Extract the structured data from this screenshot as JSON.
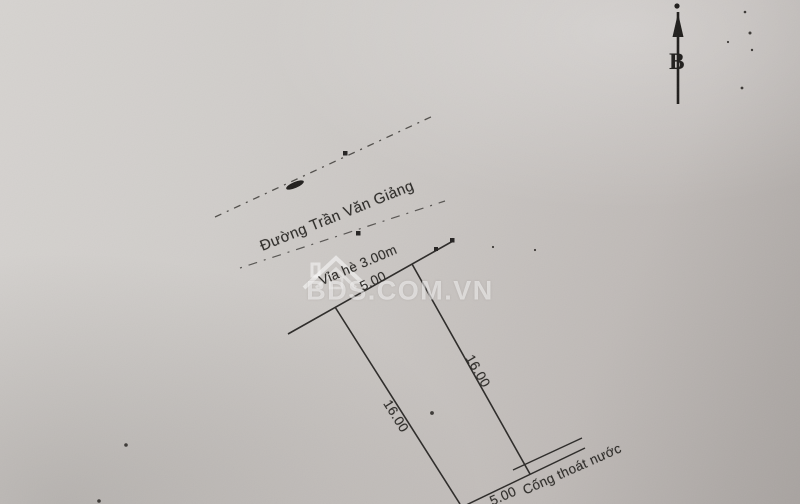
{
  "document": {
    "kind": "land-plot-survey-sketch-photo",
    "compass": {
      "north_label": "B"
    },
    "road": {
      "street_name": "Đường Trần Văn Giảng",
      "sidewalk_label": "Vỉa hè 3.00m"
    },
    "plot": {
      "front_width": "5.00",
      "left_depth": "16.00",
      "right_depth": "16.00",
      "rear_width": "5.00",
      "rear_feature": "Cống thoát nước"
    },
    "watermark": {
      "text": "BDS.COM.VN",
      "logo_icon": "house-roof-icon"
    },
    "colors": {
      "paper_light": "#d6d3d0",
      "paper_dark": "#a8a3a0",
      "ink": "#2d2b28",
      "watermark": "rgba(255,255,255,0.52)"
    }
  }
}
